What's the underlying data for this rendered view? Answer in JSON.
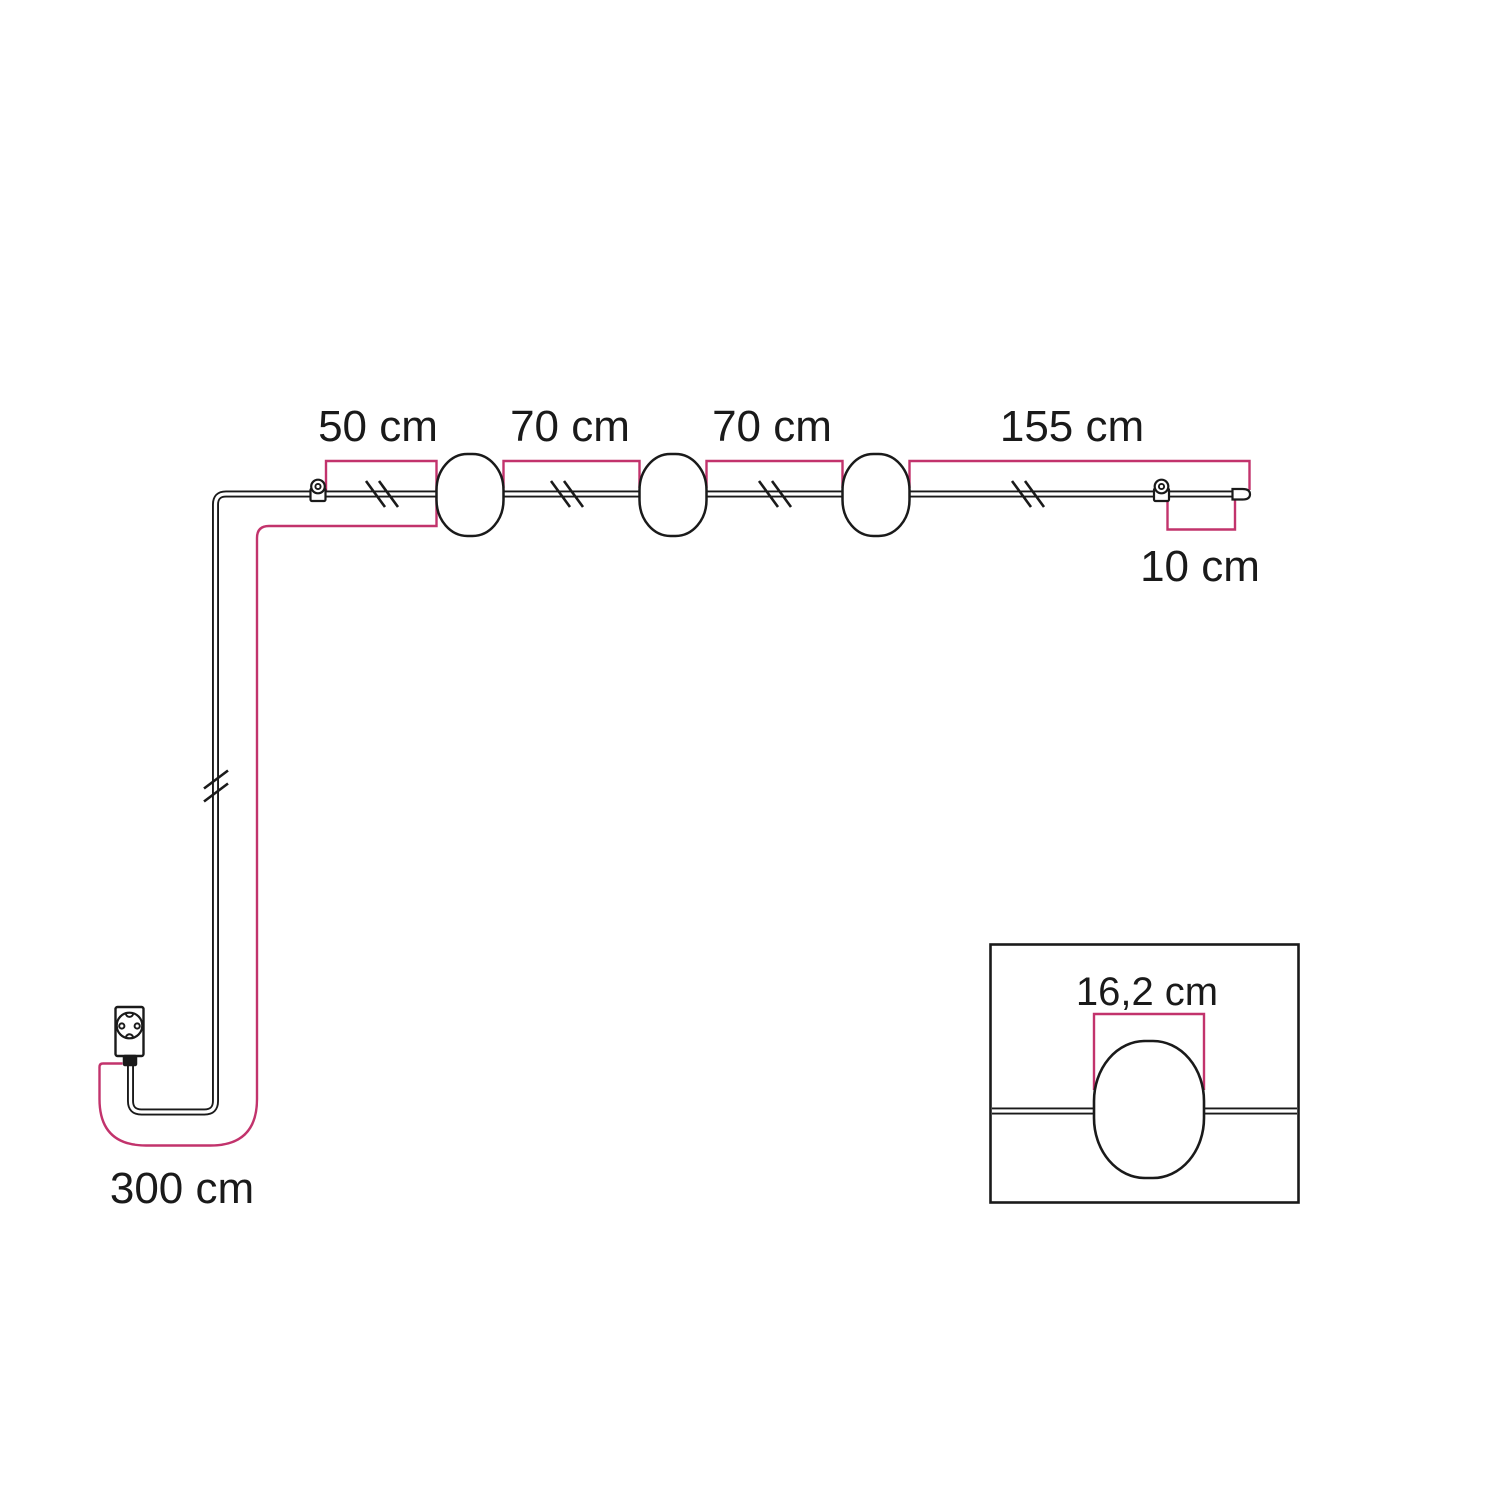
{
  "dimensions": {
    "hook_to_first_lamp": "50 cm",
    "first_to_second_lamp": "70 cm",
    "second_to_third_lamp": "70 cm",
    "third_lamp_to_end": "155 cm",
    "end_tail": "10 cm",
    "plug_to_first_hook": "300 cm",
    "lampshade_width": "16,2 cm"
  },
  "colors": {
    "dimension_line": "#C2336C",
    "outline": "#1A1A1A",
    "label_text": "#1A1A1A",
    "background": "#FFFFFF"
  }
}
